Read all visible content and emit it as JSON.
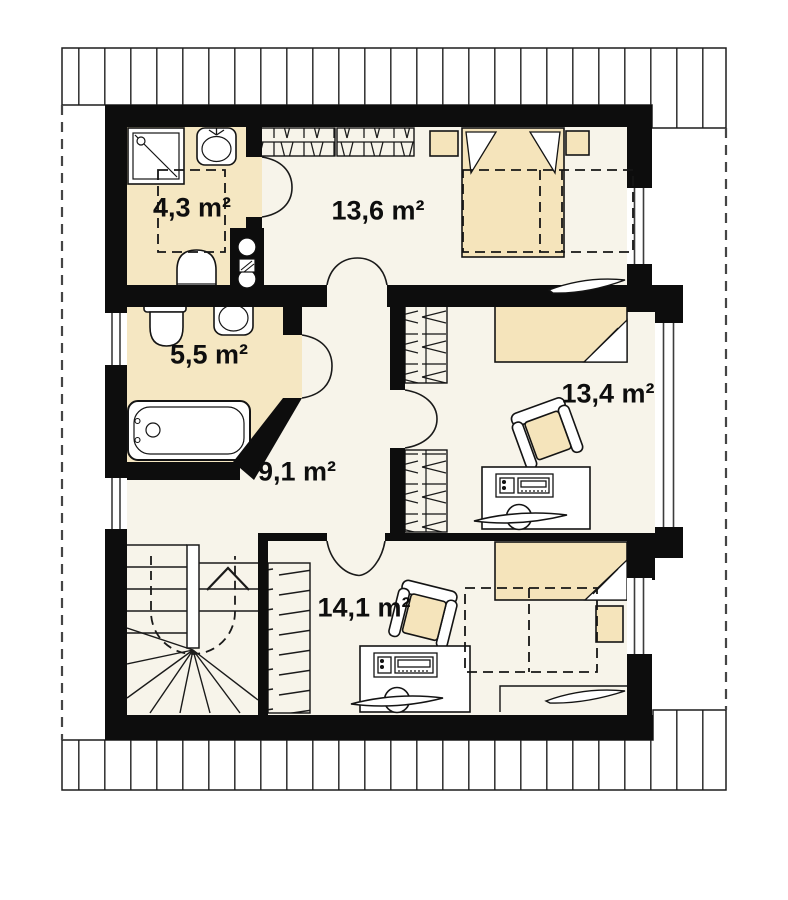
{
  "plan": {
    "title": "Attic floor plan",
    "unit": "m²",
    "rooms": [
      {
        "id": "bathroom-small",
        "area": "4,3 m²"
      },
      {
        "id": "bedroom-top",
        "area": "13,6 m²"
      },
      {
        "id": "bathroom-large",
        "area": "5,5 m²"
      },
      {
        "id": "bedroom-right",
        "area": "13,4 m²"
      },
      {
        "id": "hallway",
        "area": "9,1 m²"
      },
      {
        "id": "bedroom-bottom",
        "area": "14,1 m²"
      }
    ],
    "fixtures": [
      "shower",
      "sink",
      "toilet",
      "bathtub",
      "chimney-flue",
      "double-bed",
      "single-bed",
      "nightstand",
      "wardrobe",
      "armchair",
      "desk",
      "desk-chair",
      "winder-stairs",
      "window",
      "door-swing",
      "roof-eave-hatch",
      "headroom-dashed-line",
      "shelf"
    ],
    "colors": {
      "wall": "#0d0d0d",
      "floor": "#f7f4ea",
      "accent": "#f5e4bb",
      "paper": "#ffffff",
      "line": "#141414"
    }
  }
}
